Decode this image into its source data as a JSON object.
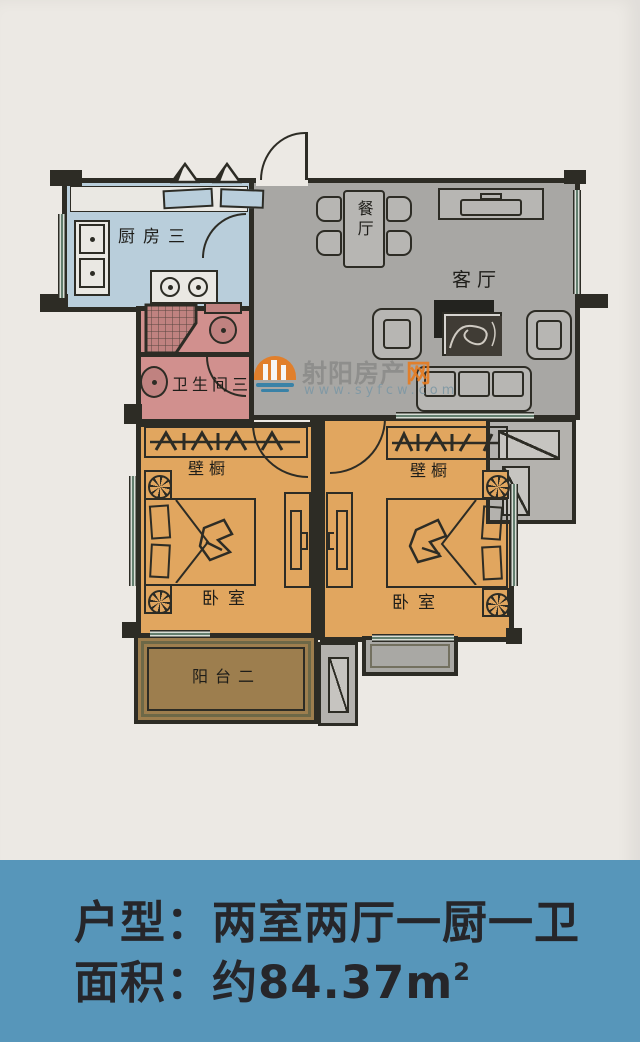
{
  "colors": {
    "wall": "#2d2c25",
    "paper": "#ece9e4",
    "living": "#a8a7a4",
    "kitchen": "#b9cedb",
    "bedroom": "#e1a65f",
    "bath": "#d1908e",
    "balcony": "#9d7e4e",
    "furn": "#b7b6b3",
    "shaft": "#b4b2ae",
    "banner": "#5796ba",
    "accent": "#e87b1e"
  },
  "plan": {
    "rooms": {
      "kitchen": {
        "label": "厨房三"
      },
      "dining": {
        "label": "餐厅"
      },
      "living": {
        "label": "客厅"
      },
      "bathroom": {
        "label": "卫生间三"
      },
      "closet_left": {
        "label": "壁橱"
      },
      "closet_right": {
        "label": "壁橱"
      },
      "bedroom_left": {
        "label": "卧室"
      },
      "bedroom_right": {
        "label": "卧室"
      },
      "balcony": {
        "label": "阳台二"
      }
    }
  },
  "watermark": {
    "site_name_main": "射阳房产",
    "site_name_accent": "网",
    "url": "www.syfcw.com"
  },
  "banner": {
    "layout_line": "户型：两室两厅一厨一卫",
    "area_prefix": "面积：约84.37m",
    "area_sup": "2"
  }
}
